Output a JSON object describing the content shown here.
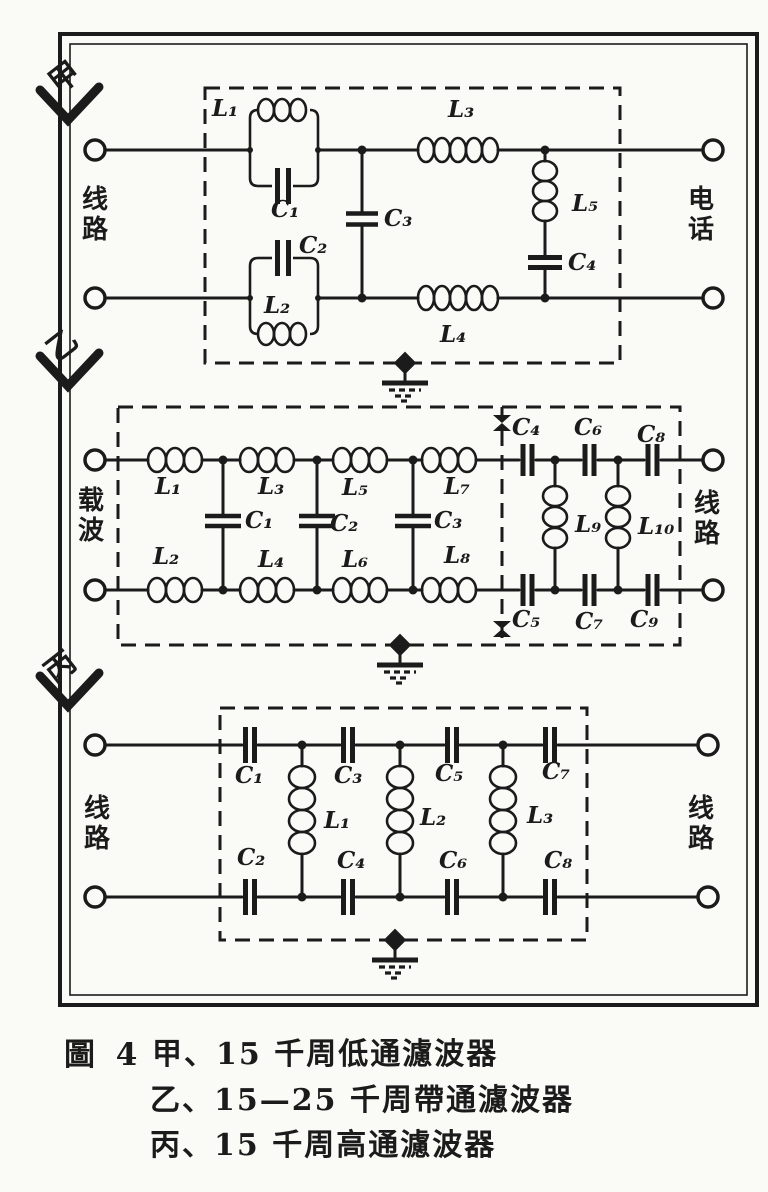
{
  "page": {
    "paper_color": "#fafaf6",
    "ink_color": "#1b1b1b"
  },
  "section_markers": {
    "jia": "甲",
    "yi": "乙",
    "bing": "丙"
  },
  "circuit_jia": {
    "port_left": "线路",
    "port_right": "电话",
    "labels": {
      "L1": "L₁",
      "C1": "C₁",
      "C2": "C₂",
      "L2": "L₂",
      "C3": "C₃",
      "L3": "L₃",
      "L4": "L₄",
      "L5": "L₅",
      "C4": "C₄"
    }
  },
  "circuit_yi": {
    "port_left": "载波",
    "port_right": "线路",
    "labels": {
      "L1": "L₁",
      "L2": "L₂",
      "L3": "L₃",
      "L4": "L₄",
      "L5": "L₅",
      "L6": "L₆",
      "L7": "L₇",
      "L8": "L₈",
      "L9": "L₉",
      "L10": "L₁₀",
      "C1": "C₁",
      "C2": "C₂",
      "C3": "C₃",
      "C4": "C₄",
      "C5": "C₅",
      "C6": "C₆",
      "C7": "C₇",
      "C8": "C₈",
      "C9": "C₉"
    }
  },
  "circuit_bing": {
    "port_left": "线路",
    "port_right": "线路",
    "labels": {
      "C1": "C₁",
      "C2": "C₂",
      "C3": "C₃",
      "C4": "C₄",
      "C5": "C₅",
      "C6": "C₆",
      "C7": "C₇",
      "C8": "C₈",
      "L1": "L₁",
      "L2": "L₂",
      "L3": "L₃"
    }
  },
  "caption": {
    "figure_label": "圖 4",
    "line1": "甲、15 千周低通濾波器",
    "line2": "乙、15—25 千周帶通濾波器",
    "line3": "丙、15 千周高通濾波器"
  }
}
